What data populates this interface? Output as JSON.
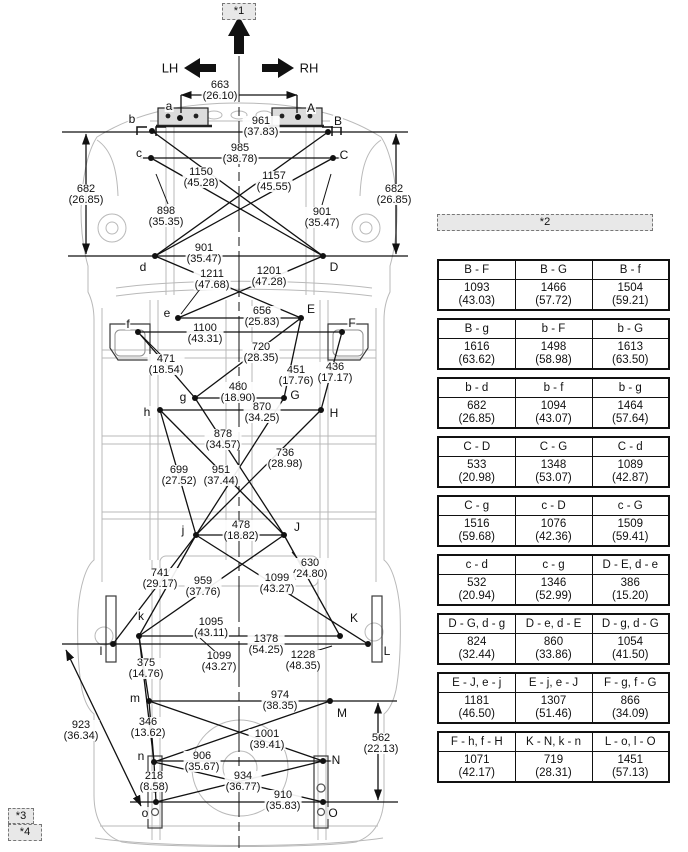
{
  "refs": {
    "r1": "*1",
    "r2": "*2",
    "r3": "*3",
    "r4": "*4"
  },
  "orientation": {
    "left": "LH",
    "right": "RH"
  },
  "diagram": {
    "points": [
      {
        "id": "a",
        "x": 180,
        "y": 118,
        "lx": 169,
        "ly": 106
      },
      {
        "id": "A",
        "x": 298,
        "y": 117,
        "lx": 311,
        "ly": 108
      },
      {
        "id": "b",
        "x": 152,
        "y": 131,
        "lx": 132,
        "ly": 119
      },
      {
        "id": "B",
        "x": 328,
        "y": 132,
        "lx": 338,
        "ly": 121
      },
      {
        "id": "c",
        "x": 151,
        "y": 158,
        "lx": 139,
        "ly": 153
      },
      {
        "id": "C",
        "x": 333,
        "y": 158,
        "lx": 344,
        "ly": 155
      },
      {
        "id": "d",
        "x": 155,
        "y": 256,
        "lx": 143,
        "ly": 267
      },
      {
        "id": "D",
        "x": 323,
        "y": 256,
        "lx": 334,
        "ly": 267
      },
      {
        "id": "e",
        "x": 178,
        "y": 318,
        "lx": 167,
        "ly": 313
      },
      {
        "id": "E",
        "x": 301,
        "y": 318,
        "lx": 311,
        "ly": 309
      },
      {
        "id": "f",
        "x": 138,
        "y": 332,
        "lx": 128,
        "ly": 324
      },
      {
        "id": "F",
        "x": 342,
        "y": 332,
        "lx": 352,
        "ly": 323
      },
      {
        "id": "g",
        "x": 195,
        "y": 398,
        "lx": 183,
        "ly": 397
      },
      {
        "id": "G",
        "x": 284,
        "y": 398,
        "lx": 295,
        "ly": 395
      },
      {
        "id": "h",
        "x": 160,
        "y": 410,
        "lx": 147,
        "ly": 412
      },
      {
        "id": "H",
        "x": 321,
        "y": 410,
        "lx": 334,
        "ly": 413
      },
      {
        "id": "j",
        "x": 196,
        "y": 535,
        "lx": 183,
        "ly": 530
      },
      {
        "id": "J",
        "x": 284,
        "y": 535,
        "lx": 297,
        "ly": 527
      },
      {
        "id": "k",
        "x": 139,
        "y": 636,
        "lx": 141,
        "ly": 616
      },
      {
        "id": "K",
        "x": 340,
        "y": 636,
        "lx": 354,
        "ly": 618
      },
      {
        "id": "l",
        "x": 113,
        "y": 644,
        "lx": 101,
        "ly": 651
      },
      {
        "id": "L",
        "x": 368,
        "y": 644,
        "lx": 387,
        "ly": 651
      },
      {
        "id": "m",
        "x": 149,
        "y": 701,
        "lx": 135,
        "ly": 698
      },
      {
        "id": "M",
        "x": 330,
        "y": 701,
        "lx": 342,
        "ly": 713
      },
      {
        "id": "n",
        "x": 154,
        "y": 762,
        "lx": 141,
        "ly": 756
      },
      {
        "id": "N",
        "x": 323,
        "y": 761,
        "lx": 336,
        "ly": 760
      },
      {
        "id": "o",
        "x": 156,
        "y": 802,
        "lx": 145,
        "ly": 813
      },
      {
        "id": "O",
        "x": 323,
        "y": 802,
        "lx": 333,
        "ly": 813
      }
    ],
    "dims": [
      {
        "id": "663",
        "mm": "663",
        "in": "(26.10)",
        "x": 220,
        "y": 80
      },
      {
        "id": "961",
        "mm": "961",
        "in": "(37.83)",
        "x": 261,
        "y": 116
      },
      {
        "id": "985",
        "mm": "985",
        "in": "(38.78)",
        "x": 240,
        "y": 143
      },
      {
        "id": "1150",
        "mm": "1150",
        "in": "(45.28)",
        "x": 201,
        "y": 167
      },
      {
        "id": "1157",
        "mm": "1157",
        "in": "(45.55)",
        "x": 274,
        "y": 171
      },
      {
        "id": "682-left",
        "mm": "682",
        "in": "(26.85)",
        "x": 86,
        "y": 184
      },
      {
        "id": "682-right",
        "mm": "682",
        "in": "(26.85)",
        "x": 394,
        "y": 184
      },
      {
        "id": "898",
        "mm": "898",
        "in": "(35.35)",
        "x": 166,
        "y": 206
      },
      {
        "id": "901-right",
        "mm": "901",
        "in": "(35.47)",
        "x": 322,
        "y": 207
      },
      {
        "id": "901-mid",
        "mm": "901",
        "in": "(35.47)",
        "x": 204,
        "y": 243
      },
      {
        "id": "1211",
        "mm": "1211",
        "in": "(47.68)",
        "x": 212,
        "y": 269
      },
      {
        "id": "1201",
        "mm": "1201",
        "in": "(47.28)",
        "x": 269,
        "y": 266
      },
      {
        "id": "656",
        "mm": "656",
        "in": "(25.83)",
        "x": 262,
        "y": 306
      },
      {
        "id": "1100",
        "mm": "1100",
        "in": "(43.31)",
        "x": 205,
        "y": 323
      },
      {
        "id": "720",
        "mm": "720",
        "in": "(28.35)",
        "x": 261,
        "y": 342
      },
      {
        "id": "471",
        "mm": "471",
        "in": "(18.54)",
        "x": 166,
        "y": 354
      },
      {
        "id": "451",
        "mm": "451",
        "in": "(17.76)",
        "x": 296,
        "y": 365
      },
      {
        "id": "436",
        "mm": "436",
        "in": "(17.17)",
        "x": 335,
        "y": 362
      },
      {
        "id": "480",
        "mm": "480",
        "in": "(18.90)",
        "x": 238,
        "y": 382
      },
      {
        "id": "870",
        "mm": "870",
        "in": "(34.25)",
        "x": 262,
        "y": 402
      },
      {
        "id": "878",
        "mm": "878",
        "in": "(34.57)",
        "x": 223,
        "y": 429
      },
      {
        "id": "736",
        "mm": "736",
        "in": "(28.98)",
        "x": 285,
        "y": 448
      },
      {
        "id": "699",
        "mm": "699",
        "in": "(27.52)",
        "x": 179,
        "y": 465
      },
      {
        "id": "951",
        "mm": "951",
        "in": "(37.44)",
        "x": 221,
        "y": 465
      },
      {
        "id": "478",
        "mm": "478",
        "in": "(18.82)",
        "x": 241,
        "y": 520
      },
      {
        "id": "630",
        "mm": "630",
        "in": "(24.80)",
        "x": 310,
        "y": 558
      },
      {
        "id": "741",
        "mm": "741",
        "in": "(29.17)",
        "x": 160,
        "y": 568
      },
      {
        "id": "959",
        "mm": "959",
        "in": "(37.76)",
        "x": 203,
        "y": 576
      },
      {
        "id": "1099-upper",
        "mm": "1099",
        "in": "(43.27)",
        "x": 277,
        "y": 573
      },
      {
        "id": "1095",
        "mm": "1095",
        "in": "(43.11)",
        "x": 211,
        "y": 617
      },
      {
        "id": "1378",
        "mm": "1378",
        "in": "(54.25)",
        "x": 266,
        "y": 634
      },
      {
        "id": "1099-lower",
        "mm": "1099",
        "in": "(43.27)",
        "x": 219,
        "y": 651
      },
      {
        "id": "1228",
        "mm": "1228",
        "in": "(48.35)",
        "x": 303,
        "y": 650
      },
      {
        "id": "375",
        "mm": "375",
        "in": "(14.76)",
        "x": 146,
        "y": 658
      },
      {
        "id": "923",
        "mm": "923",
        "in": "(36.34)",
        "x": 81,
        "y": 720
      },
      {
        "id": "974",
        "mm": "974",
        "in": "(38.35)",
        "x": 280,
        "y": 690
      },
      {
        "id": "346",
        "mm": "346",
        "in": "(13.62)",
        "x": 148,
        "y": 717
      },
      {
        "id": "1001",
        "mm": "1001",
        "in": "(39.41)",
        "x": 267,
        "y": 729
      },
      {
        "id": "562",
        "mm": "562",
        "in": "(22.13)",
        "x": 381,
        "y": 733
      },
      {
        "id": "906",
        "mm": "906",
        "in": "(35.67)",
        "x": 202,
        "y": 751
      },
      {
        "id": "218",
        "mm": "218",
        "in": "(8.58)",
        "x": 154,
        "y": 771
      },
      {
        "id": "934",
        "mm": "934",
        "in": "(36.77)",
        "x": 243,
        "y": 771
      },
      {
        "id": "910",
        "mm": "910",
        "in": "(35.83)",
        "x": 283,
        "y": 790
      }
    ]
  },
  "table": {
    "groups": [
      {
        "cells": [
          {
            "pair": "B - F",
            "mm": "1093",
            "in": "(43.03)"
          },
          {
            "pair": "B - G",
            "mm": "1466",
            "in": "(57.72)"
          },
          {
            "pair": "B - f",
            "mm": "1504",
            "in": "(59.21)"
          }
        ]
      },
      {
        "cells": [
          {
            "pair": "B - g",
            "mm": "1616",
            "in": "(63.62)"
          },
          {
            "pair": "b - F",
            "mm": "1498",
            "in": "(58.98)"
          },
          {
            "pair": "b - G",
            "mm": "1613",
            "in": "(63.50)"
          }
        ]
      },
      {
        "cells": [
          {
            "pair": "b - d",
            "mm": "682",
            "in": "(26.85)"
          },
          {
            "pair": "b - f",
            "mm": "1094",
            "in": "(43.07)"
          },
          {
            "pair": "b - g",
            "mm": "1464",
            "in": "(57.64)"
          }
        ]
      },
      {
        "cells": [
          {
            "pair": "C - D",
            "mm": "533",
            "in": "(20.98)"
          },
          {
            "pair": "C - G",
            "mm": "1348",
            "in": "(53.07)"
          },
          {
            "pair": "C - d",
            "mm": "1089",
            "in": "(42.87)"
          }
        ]
      },
      {
        "cells": [
          {
            "pair": "C - g",
            "mm": "1516",
            "in": "(59.68)"
          },
          {
            "pair": "c - D",
            "mm": "1076",
            "in": "(42.36)"
          },
          {
            "pair": "c - G",
            "mm": "1509",
            "in": "(59.41)"
          }
        ]
      },
      {
        "cells": [
          {
            "pair": "c - d",
            "mm": "532",
            "in": "(20.94)"
          },
          {
            "pair": "c - g",
            "mm": "1346",
            "in": "(52.99)"
          },
          {
            "pair": "D - E, d - e",
            "mm": "386",
            "in": "(15.20)"
          }
        ]
      },
      {
        "cells": [
          {
            "pair": "D - G, d - g",
            "mm": "824",
            "in": "(32.44)"
          },
          {
            "pair": "D - e, d - E",
            "mm": "860",
            "in": "(33.86)"
          },
          {
            "pair": "D - g, d - G",
            "mm": "1054",
            "in": "(41.50)"
          }
        ]
      },
      {
        "cells": [
          {
            "pair": "E - J, e - j",
            "mm": "1181",
            "in": "(46.50)"
          },
          {
            "pair": "E - j, e - J",
            "mm": "1307",
            "in": "(51.46)"
          },
          {
            "pair": "F - g, f - G",
            "mm": "866",
            "in": "(34.09)"
          }
        ]
      },
      {
        "cells": [
          {
            "pair": "F - h, f - H",
            "mm": "1071",
            "in": "(42.17)"
          },
          {
            "pair": "K - N, k - n",
            "mm": "719",
            "in": "(28.31)"
          },
          {
            "pair": "L - o, l - O",
            "mm": "1451",
            "in": "(57.13)"
          }
        ]
      }
    ]
  }
}
